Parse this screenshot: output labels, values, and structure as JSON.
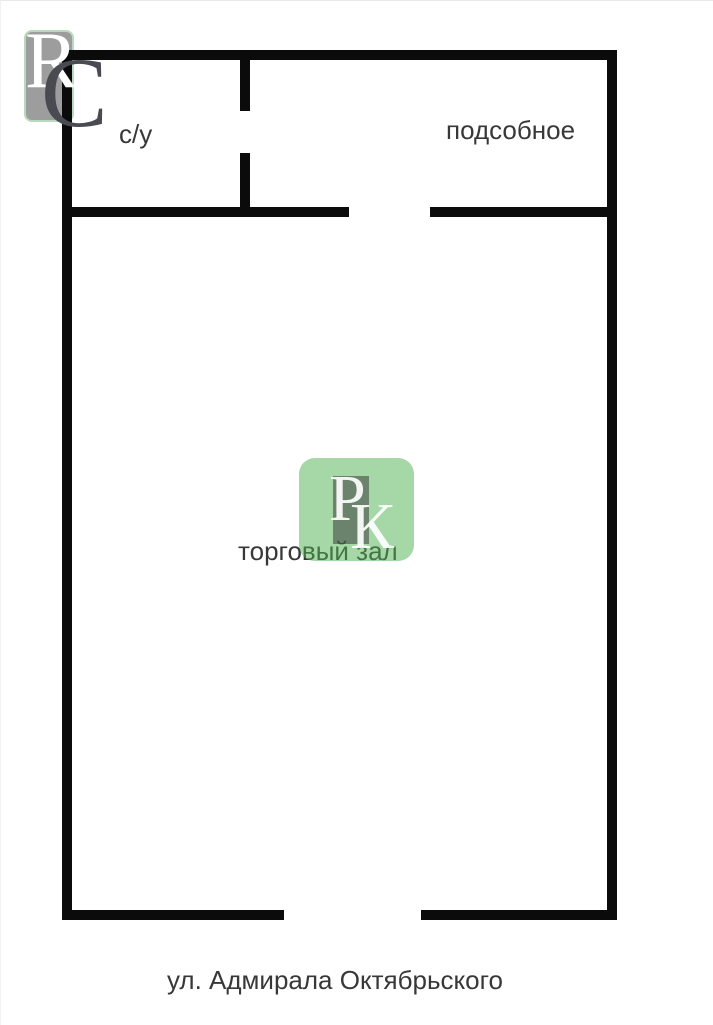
{
  "rooms": {
    "bathroom": {
      "label": "с/у"
    },
    "utility": {
      "label": "подсобное"
    },
    "sales_hall": {
      "label": "торговый зал"
    }
  },
  "street": {
    "label": "ул. Адмирала Октябрьского"
  },
  "corner_logo": {
    "letter_r": "R",
    "letter_c": "C"
  },
  "watermark": {
    "letter_p": "Р",
    "letter_k": "К"
  },
  "colors": {
    "wall": "#0b0b0b",
    "label_text": "#383838",
    "corner_logo_gray": "#9d9d9d",
    "corner_logo_border": "#b9d9be",
    "corner_letter_c": "#4a4a52",
    "watermark_green": "rgba(76,175,80,0.5)",
    "watermark_gray": "rgba(60,60,60,0.55)",
    "watermark_letter": "rgba(255,255,255,0.92)"
  }
}
